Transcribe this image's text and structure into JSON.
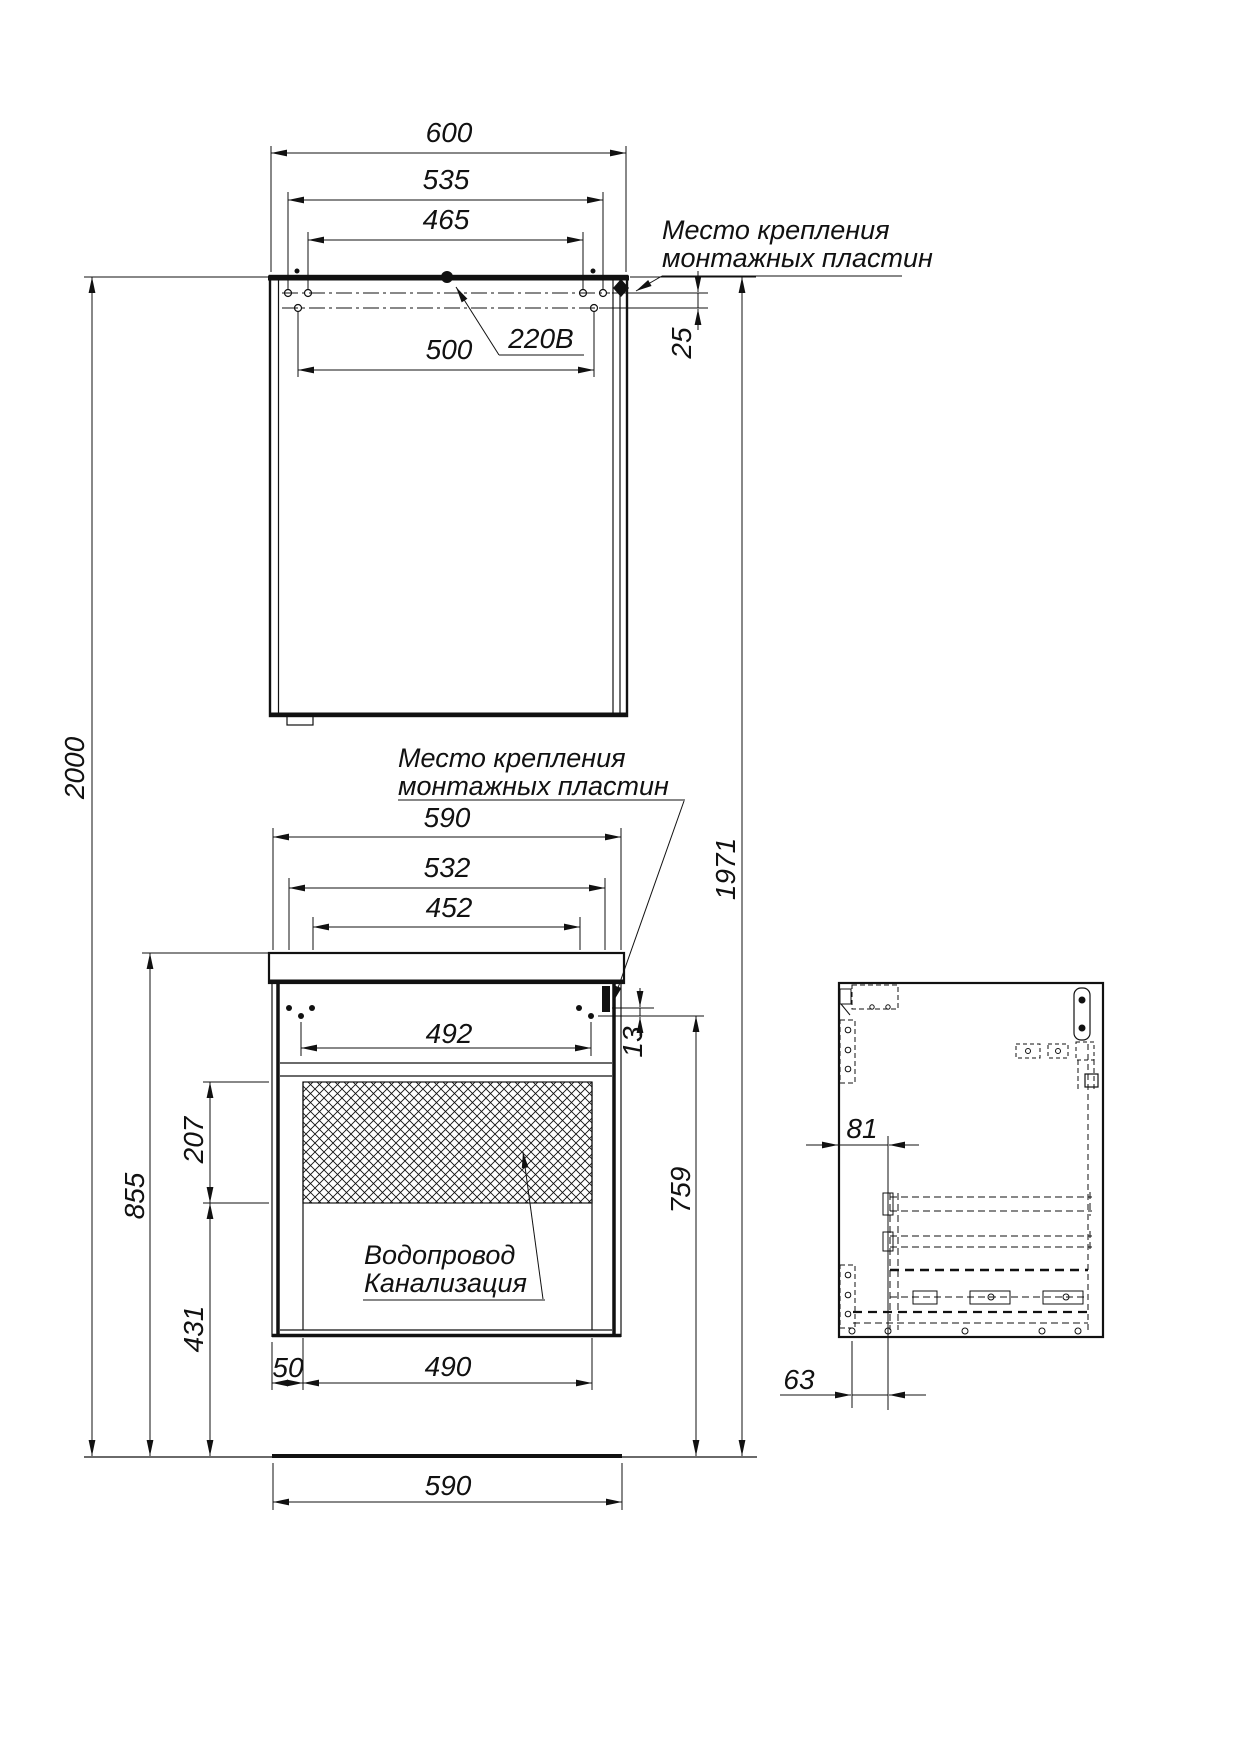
{
  "drawing": {
    "title_hint": "installation dimensions drawing",
    "ink": "#111111",
    "mirror": {
      "width": "600",
      "plates_outer": "535",
      "plates_inner": "465",
      "holes_lower": "500",
      "rows_gap": "25",
      "power": "220В"
    },
    "vanity": {
      "width": "590",
      "plates_outer": "532",
      "plates_inner": "452",
      "holes_lower": "492",
      "rows_gap": "13",
      "service_offset": "50",
      "service_width": "490",
      "footprint": "590"
    },
    "heights": {
      "total": "2000",
      "mirror_top": "1971",
      "vanity_top": "855",
      "service_zone": "207",
      "service_bottom": "431",
      "right_drop": "759"
    },
    "side_view": {
      "front_offset": "81",
      "back_offset": "63"
    },
    "notes": {
      "mount_top_1": "Место крепления",
      "mount_top_2": "монтажных пластин",
      "mount_mid_1": "Место крепления",
      "mount_mid_2": "монтажных пластин",
      "plumb_1": "Водопровод",
      "plumb_2": "Канализация"
    }
  }
}
